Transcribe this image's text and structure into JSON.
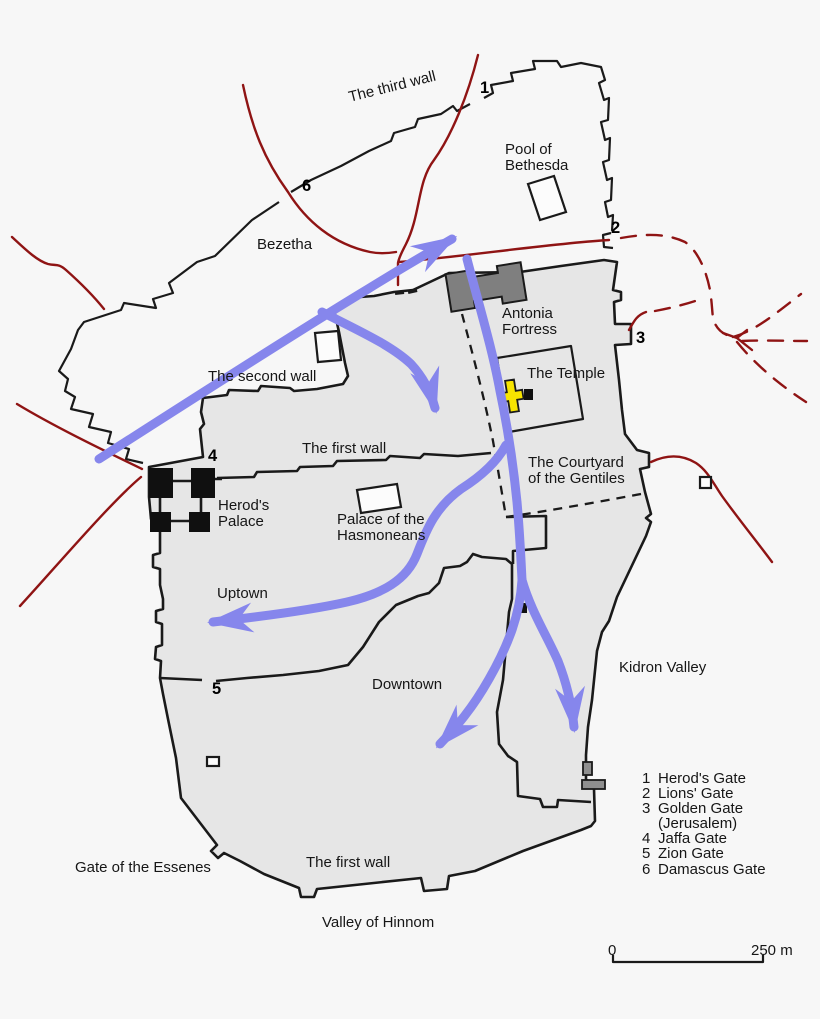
{
  "map": {
    "region_labels": {
      "third_wall": "The third wall",
      "bezetha": "Bezetha",
      "second_wall": "The second wall",
      "first_wall_north": "The first wall",
      "uptown": "Uptown",
      "downtown": "Downtown",
      "kidron_valley": "Kidron Valley",
      "gate_of_the_essenes": "Gate of the Essenes",
      "first_wall_south": "The first wall",
      "valley_of_hinnom": "Valley of Hinnom"
    },
    "landmark_labels": {
      "pool_of_bethesda": "Pool of\nBethesda",
      "antonia_fortress": "Antonia\nFortress",
      "the_temple": "The Temple",
      "herods_palace": "Herod's\nPalace",
      "palace_of_the_hasmoneans": "Palace of the\nHasmoneans",
      "courtyard_of_the_gentiles": "The Courtyard\nof the Gentiles"
    },
    "gates": [
      {
        "number": "1"
      },
      {
        "number": "2"
      },
      {
        "number": "3"
      },
      {
        "number": "4"
      },
      {
        "number": "5"
      },
      {
        "number": "6"
      }
    ],
    "legend": {
      "rows": [
        {
          "num": "1",
          "name": "Herod's Gate"
        },
        {
          "num": "2",
          "name": "Lions' Gate"
        },
        {
          "num": "3",
          "name": "Golden Gate"
        },
        {
          "num": "",
          "name": "(Jerusalem)"
        },
        {
          "num": "4",
          "name": "Jaffa Gate"
        },
        {
          "num": "5",
          "name": "Zion Gate"
        },
        {
          "num": "6",
          "name": "Damascus Gate"
        }
      ]
    },
    "scale_bar": {
      "start": "0",
      "end": "250 m"
    },
    "colors": {
      "city_fill": "#e6e6e6",
      "wall": "#1a1a1a",
      "road_red": "#8f1414",
      "route_blue": "#8686ec",
      "fortress_gray": "#7f7f7f",
      "temple_yellow": "#f7e400",
      "structure_white": "#fcfcfc",
      "gate_gray": "#8f8f8f"
    }
  }
}
